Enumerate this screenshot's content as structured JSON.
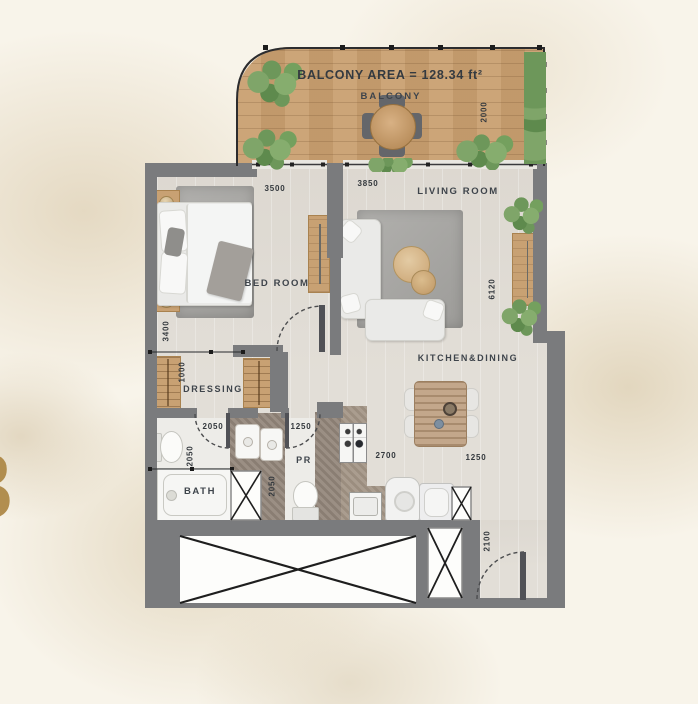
{
  "unit": {
    "number_fragment": "3"
  },
  "balcony": {
    "area_label": "BALCONY AREA = 128.34 ft²",
    "label": "BALCONY",
    "dim_depth": "2000"
  },
  "bedroom": {
    "label": "BED ROOM",
    "dim_width": "3500",
    "dim_depth": "3400"
  },
  "living_room": {
    "label": "LIVING ROOM",
    "dim_width": "3850",
    "dim_depth": "6120"
  },
  "kitchen_dining": {
    "label": "KITCHEN&DINING",
    "dim_width": "2700",
    "dim_passage": "1250"
  },
  "dressing": {
    "label": "DRESSING",
    "dim_depth": "1000"
  },
  "bath": {
    "label": "BATH",
    "dim_width": "2050",
    "dim_depth": "2050"
  },
  "powder_room": {
    "label": "PR",
    "dim_width": "1250",
    "dim_depth": "2050"
  },
  "entry": {
    "dim_height": "2100"
  },
  "colors": {
    "wall": "#7a7b7d",
    "wood_deck": "#c9a071",
    "floor": "#e2ded7",
    "counter": "#a39586",
    "text": "#3e444b",
    "gold": "#ab8440",
    "plant": "#76a05f"
  }
}
